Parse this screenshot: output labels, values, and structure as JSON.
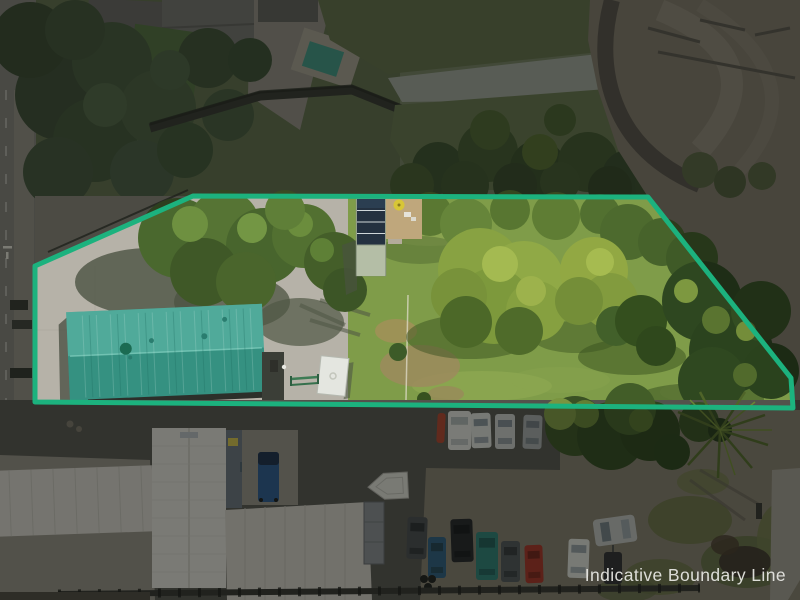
{
  "watermark": {
    "label": "Indicative Boundary Line",
    "color": "#e9e9e5"
  },
  "boundary": {
    "points": "35,266 193,196 648,197 791,378 793,408 35,402",
    "color": "#1cb27e",
    "stroke_width": 5,
    "dim_color": "rgba(10,14,12,0.45)"
  },
  "palette": {
    "roof_teal": "#3f9e8e",
    "solar_panels": "#243140",
    "solar_lower_roof": "#b4bea6",
    "shed": "#e4e6e0",
    "pool": "#3f8f7d",
    "lawn": "#7f9c49",
    "concrete": "#b6b2a8",
    "asphalt": "#53524c",
    "gravel": "#7f7868",
    "estuary_mud": "#7a7365",
    "creek_stones": "#979d92",
    "deck_tan": "#bfa77c",
    "road": "#7c7a74"
  },
  "shapes": {
    "neighbour_trees": [
      [
        60,
        95,
        45,
        "#3b4a33"
      ],
      [
        112,
        62,
        40,
        "#43553a"
      ],
      [
        95,
        140,
        42,
        "#3e5035"
      ],
      [
        158,
        108,
        38,
        "#475a3d"
      ],
      [
        208,
        58,
        30,
        "#3c4d34"
      ],
      [
        58,
        172,
        35,
        "#41513a"
      ],
      [
        142,
        172,
        32,
        "#455840"
      ],
      [
        30,
        40,
        38,
        "#37462f"
      ],
      [
        75,
        30,
        30,
        "#3f4f36"
      ],
      [
        185,
        150,
        28,
        "#3f5236"
      ],
      [
        228,
        115,
        26,
        "#44573b"
      ],
      [
        250,
        60,
        22,
        "#3a4b32"
      ],
      [
        105,
        105,
        22,
        "#4e6243"
      ],
      [
        170,
        70,
        20,
        "#4a5e40"
      ]
    ],
    "stream_trees": [
      [
        438,
        168,
        26,
        "#3a4e2c"
      ],
      [
        488,
        152,
        30,
        "#41552f"
      ],
      [
        538,
        168,
        28,
        "#374b29"
      ],
      [
        588,
        162,
        30,
        "#3e532d"
      ],
      [
        628,
        176,
        26,
        "#36482a"
      ],
      [
        412,
        185,
        22,
        "#44582f"
      ],
      [
        465,
        185,
        24,
        "#3c502c"
      ],
      [
        515,
        185,
        22,
        "#354628"
      ],
      [
        560,
        182,
        20,
        "#40542e"
      ],
      [
        610,
        188,
        22,
        "#324326"
      ],
      [
        655,
        185,
        20,
        "#384a2b"
      ],
      [
        540,
        152,
        18,
        "#52682f"
      ],
      [
        490,
        130,
        20,
        "#4b6130"
      ],
      [
        560,
        120,
        16,
        "#465c2e"
      ],
      [
        690,
        210,
        24,
        "#2f4722"
      ],
      [
        720,
        250,
        26,
        "#2b431f"
      ],
      [
        755,
        290,
        24,
        "#2e4621"
      ],
      [
        780,
        330,
        22,
        "#2a421e"
      ],
      [
        795,
        365,
        18,
        "#304822"
      ]
    ],
    "property_trees": [
      [
        178,
        238,
        40,
        "#4a682e"
      ],
      [
        224,
        226,
        36,
        "#567434"
      ],
      [
        264,
        246,
        38,
        "#48652d"
      ],
      [
        304,
        236,
        32,
        "#527031"
      ],
      [
        334,
        262,
        30,
        "#445e29"
      ],
      [
        204,
        272,
        34,
        "#3f5827"
      ],
      [
        246,
        282,
        30,
        "#4a652c"
      ],
      [
        190,
        224,
        18,
        "#6e9040"
      ],
      [
        252,
        228,
        15,
        "#739644"
      ],
      [
        300,
        224,
        13,
        "#6b8d3d"
      ],
      [
        322,
        250,
        12,
        "#5e8036"
      ],
      [
        285,
        210,
        20,
        "#5f7f38"
      ],
      [
        345,
        290,
        22,
        "#3c5526"
      ],
      [
        430,
        214,
        22,
        "#5a7832"
      ],
      [
        466,
        224,
        26,
        "#66853a"
      ],
      [
        510,
        210,
        20,
        "#587631"
      ],
      [
        556,
        216,
        24,
        "#5f7d34"
      ],
      [
        600,
        214,
        20,
        "#527030"
      ],
      [
        628,
        232,
        28,
        "#4d6a2e"
      ],
      [
        662,
        242,
        24,
        "#47632b"
      ],
      [
        692,
        258,
        26,
        "#3f5a27"
      ],
      [
        480,
        270,
        42,
        "#88a242"
      ],
      [
        524,
        281,
        40,
        "#90a946"
      ],
      [
        494,
        306,
        38,
        "#7d993c"
      ],
      [
        536,
        311,
        30,
        "#86a040"
      ],
      [
        459,
        296,
        28,
        "#78923a"
      ],
      [
        500,
        264,
        18,
        "#a4ba51"
      ],
      [
        531,
        291,
        15,
        "#9db24c"
      ],
      [
        466,
        322,
        26,
        "#4c6828"
      ],
      [
        519,
        331,
        24,
        "#4f6b2a"
      ],
      [
        594,
        271,
        34,
        "#92a843"
      ],
      [
        610,
        301,
        28,
        "#829b3e"
      ],
      [
        579,
        301,
        24,
        "#748e38"
      ],
      [
        600,
        262,
        14,
        "#a6bb50"
      ],
      [
        616,
        326,
        20,
        "#42602a"
      ],
      [
        641,
        321,
        26,
        "#344f1e"
      ],
      [
        656,
        346,
        20,
        "#2f481c"
      ],
      [
        702,
        301,
        40,
        "#2e4720"
      ],
      [
        731,
        351,
        42,
        "#2b431e"
      ],
      [
        761,
        311,
        30,
        "#334d22"
      ],
      [
        712,
        381,
        34,
        "#2f4820"
      ],
      [
        771,
        371,
        28,
        "#2a421d"
      ],
      [
        686,
        291,
        12,
        "#7d9840"
      ],
      [
        746,
        331,
        10,
        "#748d3a"
      ],
      [
        716,
        320,
        14,
        "#5a7430"
      ],
      [
        745,
        375,
        12,
        "#516a2c"
      ],
      [
        398,
        352,
        9,
        "#3c5b28"
      ],
      [
        424,
        399,
        7,
        "#37521f"
      ]
    ],
    "bottom_trees": [
      [
        575,
        426,
        30,
        "#3a5124"
      ],
      [
        611,
        436,
        34,
        "#31471f"
      ],
      [
        650,
        431,
        30,
        "#2c431d"
      ],
      [
        630,
        409,
        26,
        "#425d28"
      ],
      [
        585,
        414,
        14,
        "#637f33"
      ],
      [
        641,
        420,
        12,
        "#55702c"
      ],
      [
        560,
        414,
        16,
        "#7a9440"
      ],
      [
        699,
        422,
        20,
        "#354d22"
      ],
      [
        672,
        452,
        18,
        "#2b421c"
      ]
    ],
    "estuary_grass": [
      [
        700,
        170,
        18,
        "#55603f"
      ],
      [
        730,
        182,
        16,
        "#4c5738"
      ],
      [
        762,
        176,
        14,
        "#525d3c"
      ]
    ],
    "lawn_patches": [
      [
        430,
        228,
        52,
        18,
        "#93ab55",
        0.55
      ],
      [
        482,
        386,
        70,
        15,
        "#95ad55",
        0.5
      ],
      [
        700,
        392,
        40,
        11,
        "#8ea651",
        0.45
      ],
      [
        560,
        380,
        50,
        13,
        "#8aa54f",
        0.4
      ]
    ],
    "dirt_patches": [
      [
        420,
        366,
        40,
        21,
        "#9b8c5c",
        0.9
      ],
      [
        396,
        331,
        21,
        12,
        "#a29158",
        0.85
      ],
      [
        446,
        394,
        18,
        8,
        "#99895a",
        0.8
      ],
      [
        471,
        300,
        13,
        7,
        "#90954f",
        0.5
      ]
    ],
    "shadow_blobs": [
      [
        150,
        282,
        75,
        34,
        "#4c5342",
        0.8
      ],
      [
        232,
        302,
        58,
        28,
        "#4c5342",
        0.75
      ],
      [
        300,
        322,
        44,
        24,
        "#505744",
        0.7
      ],
      [
        470,
        337,
        64,
        22,
        "#3a521f",
        0.5
      ],
      [
        576,
        337,
        44,
        16,
        "#3a521f",
        0.45
      ],
      [
        632,
        357,
        54,
        18,
        "#37501e",
        0.5
      ],
      [
        700,
        399,
        64,
        16,
        "#344c1d",
        0.5
      ],
      [
        420,
        250,
        40,
        14,
        "#46602c",
        0.4
      ]
    ],
    "gravel_grass": [
      [
        690,
        520,
        42,
        24,
        "#646c40",
        0.85
      ],
      [
        747,
        562,
        46,
        26,
        "#5f6840",
        0.9
      ],
      [
        660,
        577,
        36,
        18,
        "#666e42",
        0.8
      ],
      [
        783,
        540,
        26,
        38,
        "#6a7245",
        0.85
      ],
      [
        703,
        482,
        26,
        13,
        "#6b7344",
        0.7
      ],
      [
        627,
        590,
        30,
        12,
        "#5d6640",
        0.7
      ],
      [
        745,
        562,
        26,
        16,
        "#3b332a",
        0.9
      ],
      [
        725,
        545,
        14,
        10,
        "#46392c",
        0.8
      ]
    ],
    "cars_row1": [
      [
        437,
        413,
        8,
        30,
        "#a8422c",
        3,
        null
      ],
      [
        448,
        411,
        23,
        39,
        "#d6d6d0",
        0,
        "#a7adab"
      ],
      [
        471,
        413,
        20,
        35,
        "#d0d2cc",
        -2,
        "#828c92"
      ],
      [
        495,
        414,
        20,
        35,
        "#bfc2be",
        0,
        "#7d868c"
      ],
      [
        523,
        415,
        19,
        34,
        "#9da1a0",
        2,
        "#6d757b"
      ]
    ],
    "cars_row2": [
      [
        407,
        517,
        20,
        42,
        "#46494b",
        2,
        "#2a2e31"
      ],
      [
        428,
        537,
        18,
        41,
        "#2d5a78",
        0,
        "#22404f"
      ],
      [
        451,
        519,
        22,
        43,
        "#232527",
        -2,
        "#16181a"
      ],
      [
        476,
        532,
        22,
        48,
        "#2c7a70",
        0,
        "#1f5852"
      ],
      [
        501,
        541,
        19,
        41,
        "#4e5254",
        0,
        "#33373a"
      ],
      [
        525,
        545,
        18,
        38,
        "#9e3226",
        -2,
        "#6e2218"
      ],
      [
        568,
        539,
        21,
        39,
        "#d2d3cd",
        2,
        "#8e989c"
      ],
      [
        604,
        552,
        18,
        32,
        "#2e2f31",
        0,
        null
      ]
    ],
    "roadside_items": [
      [
        10,
        300,
        18,
        10,
        "#34362f",
        0,
        null
      ],
      [
        12,
        320,
        20,
        9,
        "#3c3e37",
        0,
        null
      ],
      [
        10,
        368,
        22,
        10,
        "#31332c",
        0,
        null
      ]
    ]
  }
}
